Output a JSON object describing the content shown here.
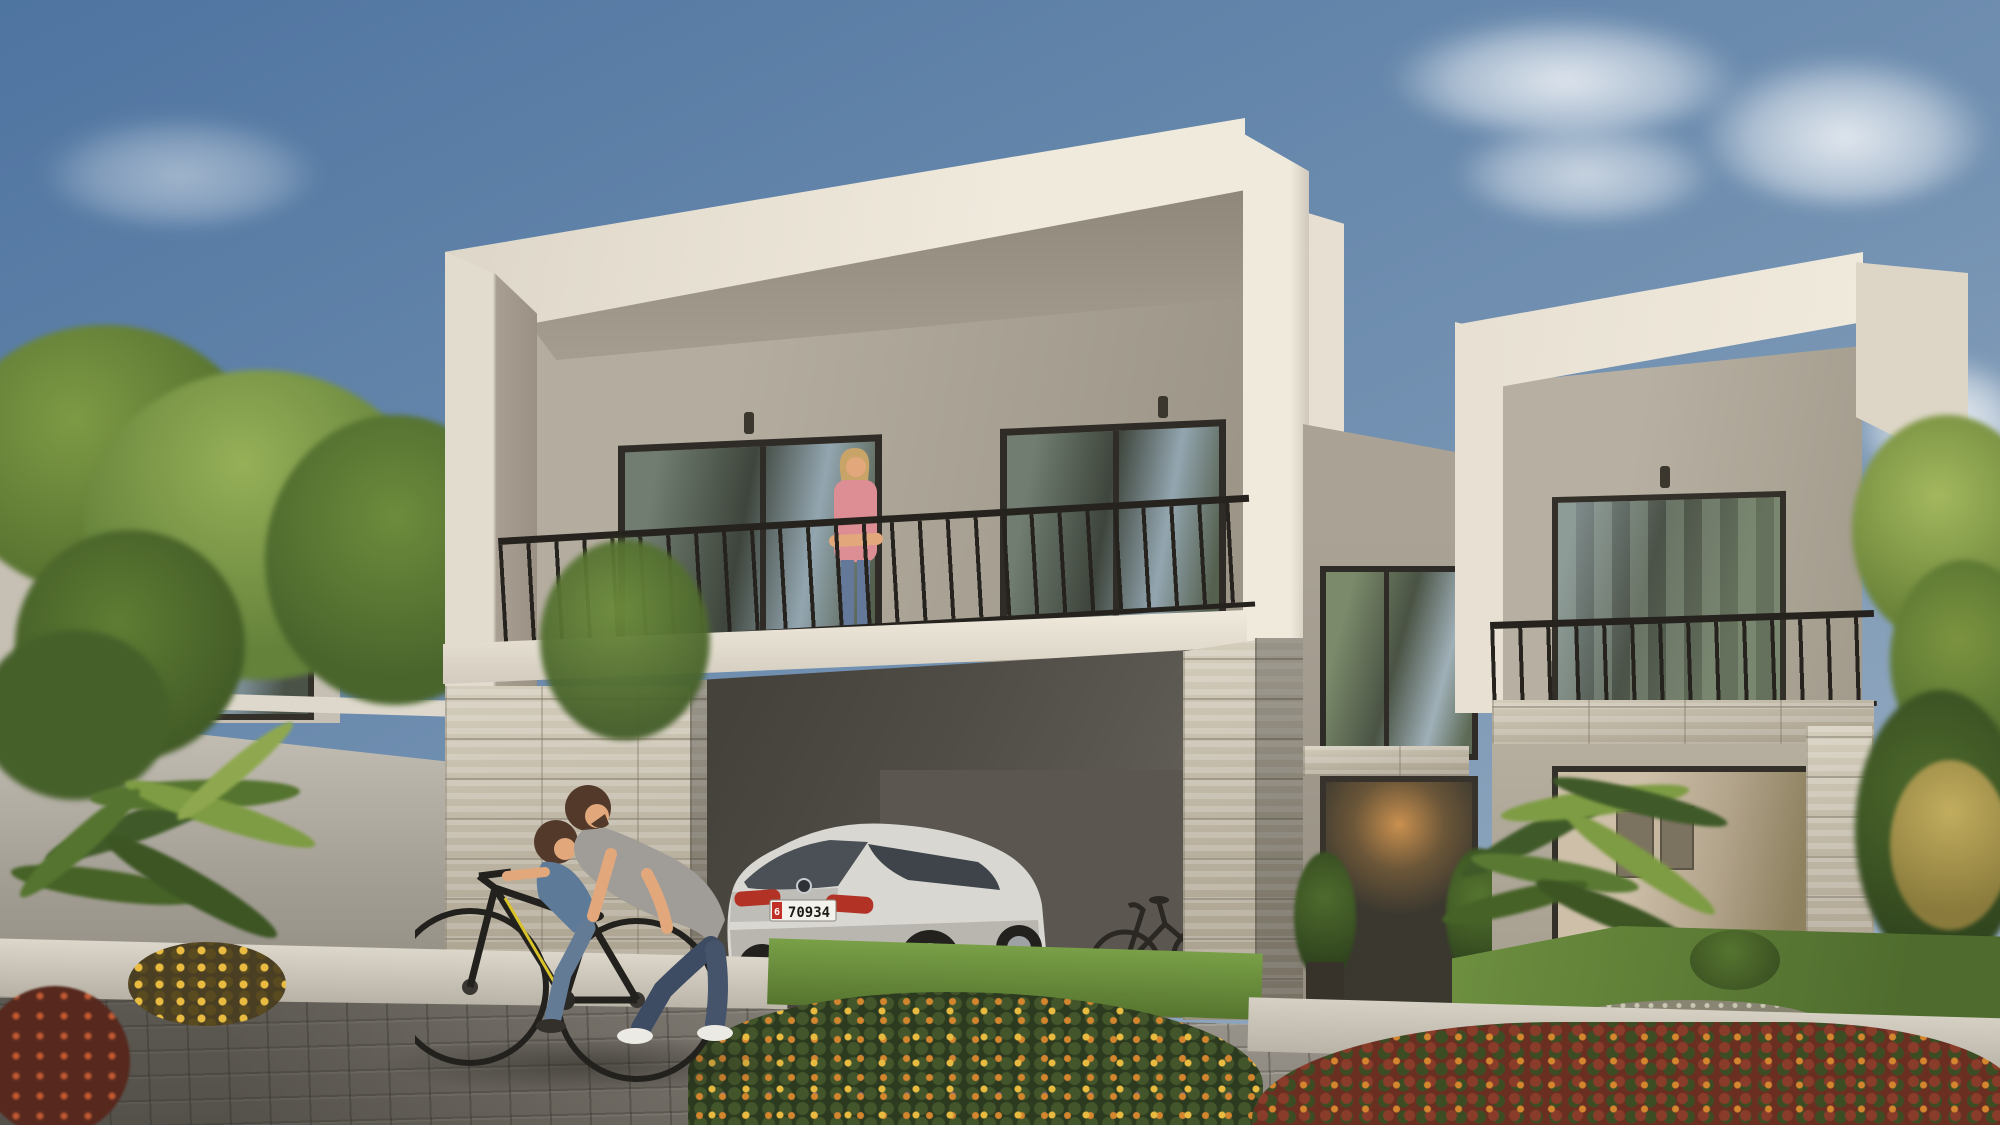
{
  "scene": {
    "title": "Modern two-storey villa exterior rendering",
    "objects": [
      "sky-with-clouds",
      "neighbor-house",
      "perimeter-wall",
      "garden-trees",
      "palm-plants",
      "main-villa",
      "balcony-railing",
      "woman-on-balcony",
      "carport",
      "silver-suv",
      "leaning-bicycle",
      "entrance-glass-door",
      "right-wing-balcony",
      "right-wing-living-room",
      "father-teaching-son-to-ride-bike",
      "paver-driveway",
      "flower-beds"
    ]
  },
  "car": {
    "type": "silver-suv",
    "plate_number": "70934",
    "plate_region": "6"
  },
  "palette": {
    "skyTop": "#4e74a0",
    "skyMid": "#7492b2",
    "skyLow": "#a3b5c6",
    "cloud": "#ffffff",
    "fasciaBright": "#f0eadd",
    "fasciaFront": "#ddd6c8",
    "soffit": "#978f82",
    "wallRecess": "#b4ad9f",
    "wallDark": "#9b9486",
    "glassDark": "#3e453c",
    "glassSky": "#93a6b0",
    "frameDark": "#2f2b26",
    "railing": "#26231f",
    "stoneLight": "#ccc5b4",
    "stoneJoint": "#8a8272",
    "carportDark": "#45423c",
    "carportMid": "#5c5852",
    "carBody": "#d9d7d2",
    "taillight": "#b23226",
    "plateWhite": "#f4f2ec",
    "plateRed": "#c03227",
    "plateText": "#1d1b18",
    "grass": "#6a8c3d",
    "paver": "#9b968d",
    "concrete": "#d5d0c3",
    "treeGreen": "#5f7d33",
    "treeLight": "#96b058",
    "treeDark": "#46602a",
    "branch": "#a85130",
    "palmDark": "#3f5a28",
    "palmLight": "#7e9c43",
    "flowerOrange": "#d4862f",
    "flowerYellow": "#e9bc41",
    "bushMaroon": "#6b2f22",
    "skin": "#e2a87c",
    "hairBrown": "#53392a",
    "hairBlonde": "#c9a468",
    "shirtGray": "#a09d98",
    "shirtBlue": "#5d7a99",
    "shirtPink": "#dd8d94",
    "jeans": "#46546b",
    "jeansLight": "#64789a",
    "shoeWhite": "#eceae4",
    "doorGlow": "#c9904f",
    "interiorWarm": "#cdbfa8"
  }
}
